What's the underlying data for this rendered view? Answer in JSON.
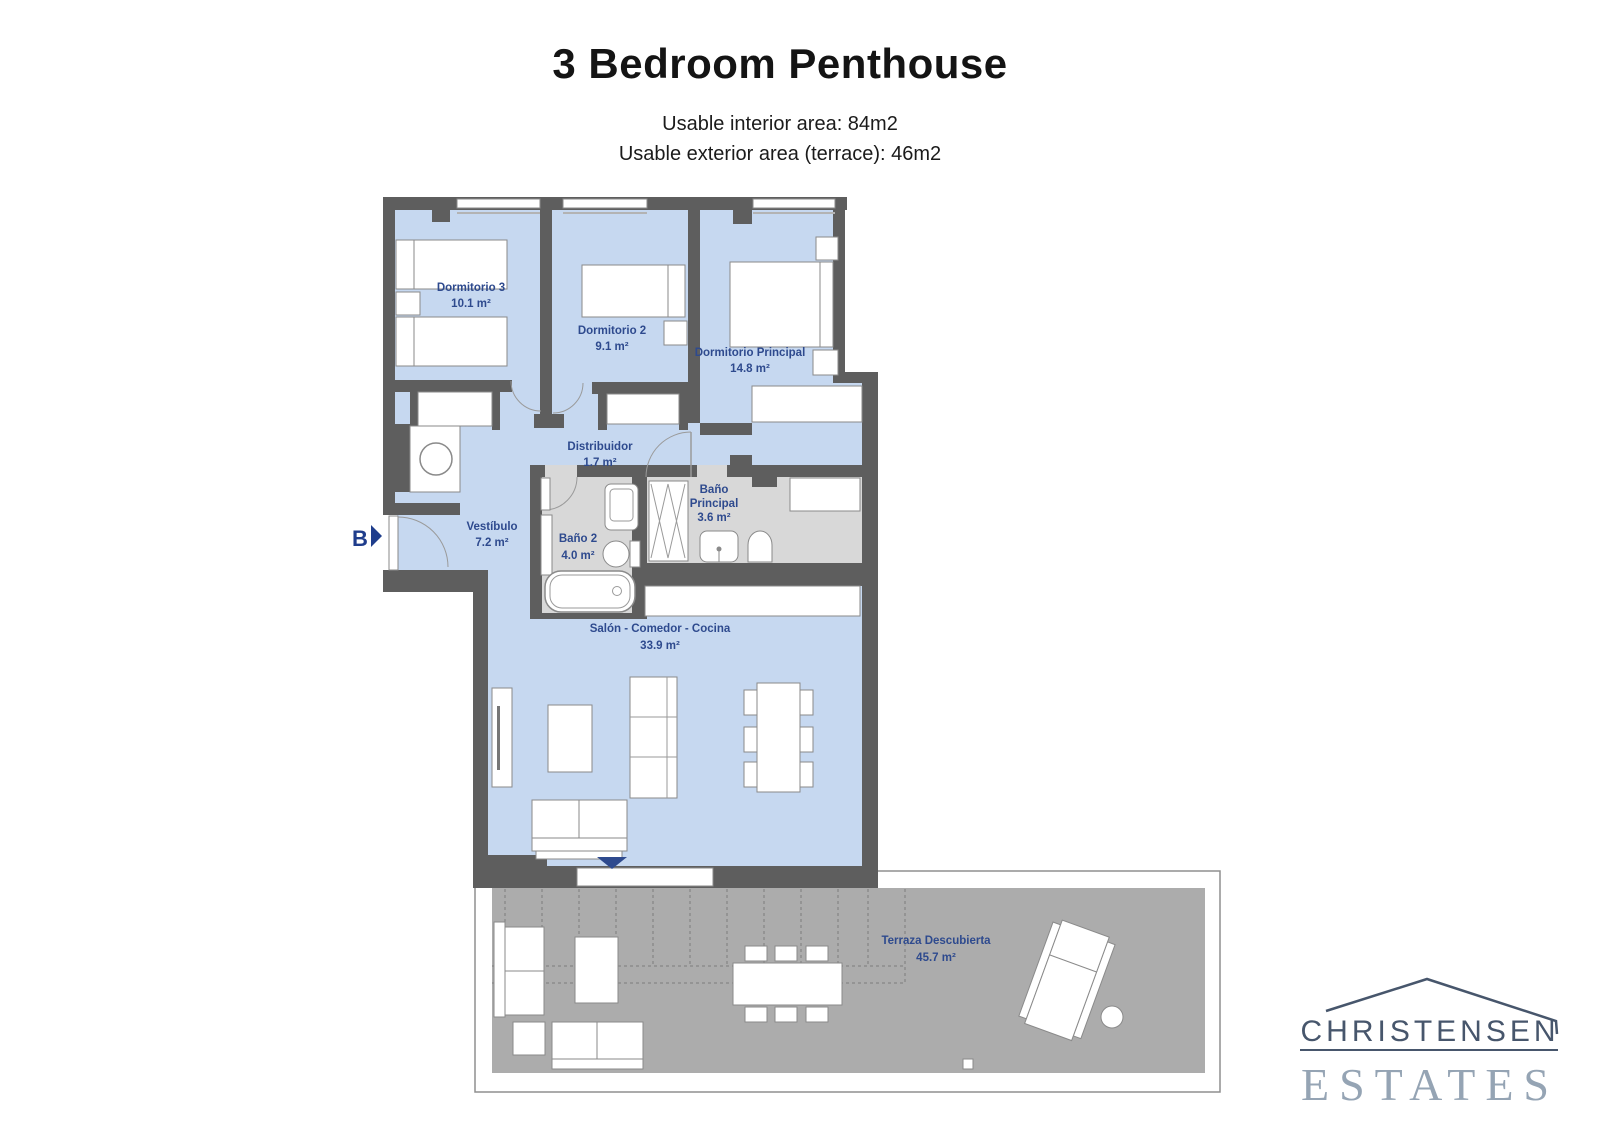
{
  "header": {
    "title": "3 Bedroom Penthouse",
    "subtitle_line1": "Usable interior area: 84m2",
    "subtitle_line2": "Usable exterior area (terrace): 46m2"
  },
  "floorplan": {
    "entrance_label": "B",
    "rooms": {
      "dormitorio3": {
        "name": "Dormitorio 3",
        "area": "10.1 m²"
      },
      "dormitorio2": {
        "name": "Dormitorio 2",
        "area": "9.1 m²"
      },
      "dormitorio_principal": {
        "name": "Dormitorio Principal",
        "area": "14.8 m²"
      },
      "distribuidor": {
        "name": "Distribuidor",
        "area": "1.7 m²"
      },
      "vestibulo": {
        "name": "Vestíbulo",
        "area": "7.2 m²"
      },
      "bano2": {
        "name": "Baño 2",
        "area": "4.0 m²"
      },
      "bano_principal": {
        "name_line1": "Baño",
        "name_line2": "Principal",
        "area": "3.6 m²"
      },
      "salon_comedor_cocina": {
        "name": "Salón - Comedor - Cocina",
        "area": "33.9 m²"
      },
      "terraza": {
        "name": "Terraza Descubierta",
        "area": "45.7 m²"
      }
    },
    "colors": {
      "floor_interior": "#c6d8f0",
      "floor_bathroom": "#d8d8d8",
      "floor_terrace": "#acacac",
      "wall": "#5e5e5e",
      "label": "#2e4a8e"
    }
  },
  "logo": {
    "line1": "CHRISTENSEN",
    "line2": "ESTATES"
  }
}
